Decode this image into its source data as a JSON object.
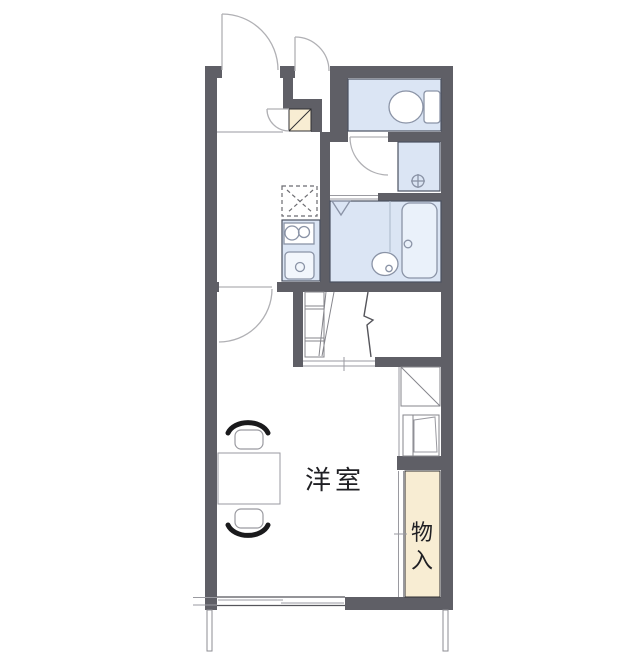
{
  "labels": {
    "western_room": "洋室",
    "storage_chars": [
      "物",
      "入"
    ]
  },
  "colors": {
    "bg": "#ffffff",
    "wall": "#5f5f66",
    "water": "#dbe5f4",
    "water_light": "#eaf1fa",
    "beige": "#f8edd3",
    "line": "#2f2f33",
    "roomline": "#4a5160",
    "fixture": "#8a93a6",
    "door": "#b0b0b4",
    "gray": "#9a9aa0",
    "ink": "#1f1f23",
    "chair": "#1a1a1c"
  },
  "icons": {
    "toilet": "toilet-icon",
    "washer_drain": "washer-drain-icon",
    "bathtub": "bathtub-icon",
    "bathroom_sink": "sink-oval-icon",
    "shower_corner": "triangle-icon",
    "stove_burners": "two-burner-icon",
    "kitchen_sink": "sink-square-icon",
    "fridge_space": "dashed-x-box-icon",
    "shoe_cabinet": "diagonal-box-icon",
    "stairs_break": "zigzag-break-icon",
    "door_swings": "quarter-arc-icon"
  }
}
